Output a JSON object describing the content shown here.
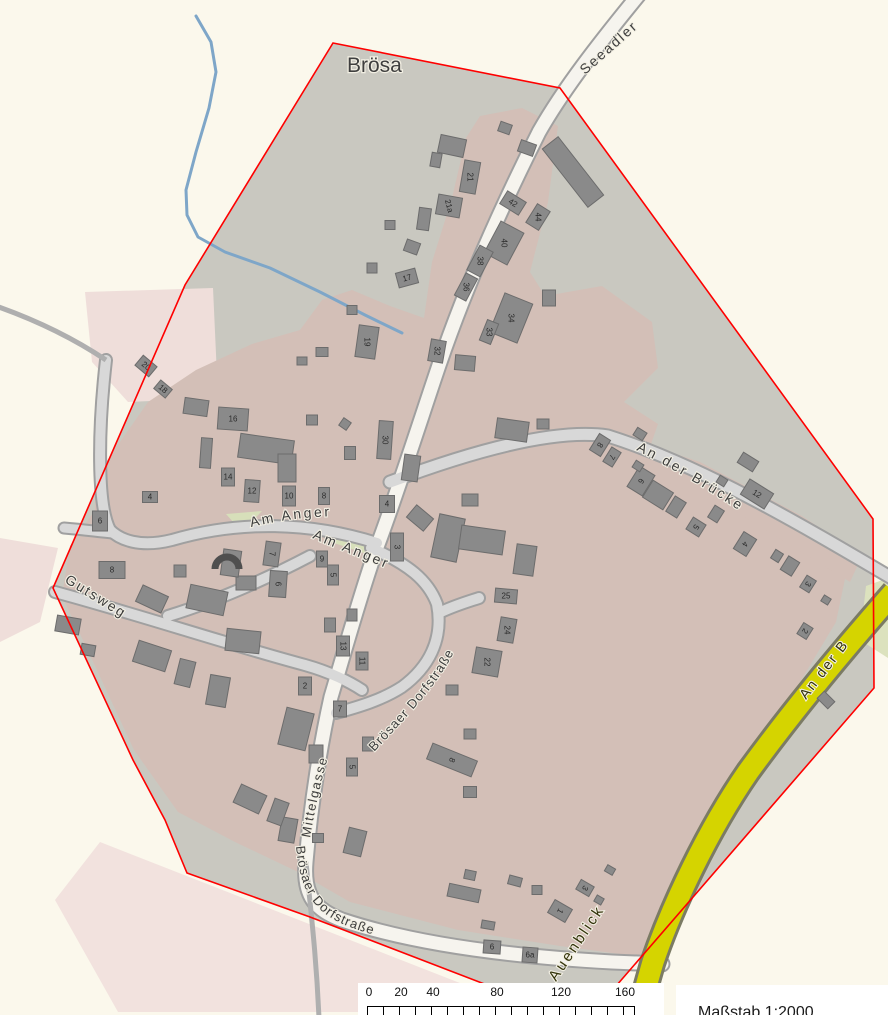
{
  "map": {
    "place_label": "Brösa",
    "scale_text": "Maßstab 1:2000",
    "colors": {
      "bg": "#FBF8EC",
      "interior": "#C9C8C0",
      "residential": "#D3BFB7",
      "residential_light": "#EFDEDA",
      "green": "#D7DFBA",
      "road_minor": "#D8D8D8",
      "road_main": "#F6F4EE",
      "road_casing": "#A0A0A0",
      "road_yellow": "#D5D400",
      "yellow_casing": "#7B7B64",
      "track": "#AFAFAF",
      "stream": "#7EA6C8",
      "boundary": "#FF0000",
      "building": "#8A8A8A",
      "building_stroke": "#6C6C6C",
      "label": "#3D3D3D",
      "halo": "#F2EFE3",
      "number": "#2B2B2B"
    },
    "boundary_pts": "333,43 560,88 873,519 874,688 597,1008 500,990 310,917 187,873 165,820 133,760 53,588 185,285",
    "areas": [
      {
        "id": "interior",
        "pts": "333,43 560,88 873,519 874,688 597,1008 500,990 310,917 187,873 165,820 133,760 53,588 185,285",
        "fill": "#C9C8C0"
      },
      {
        "id": "light-pink-nw",
        "pts": "85,292 213,288 218,398 128,402 92,362",
        "fill": "#EFDEDA"
      },
      {
        "id": "light-pink-w",
        "pts": "0,538 58,548 40,622 0,642",
        "fill": "#EFDEDA"
      },
      {
        "id": "light-pink-sw",
        "pts": "100,842 465,985 430,1012 118,1012 55,900",
        "fill": "#F2E2DE"
      },
      {
        "id": "residential-main",
        "pts": "95,478 148,402 196,370 252,344 300,330 322,300 352,290 390,306 424,318 432,262 452,198 466,138 480,116 522,108 558,126 548,202 530,272 545,296 602,286 652,322 658,368 624,402 658,424 642,470 700,490 782,534 846,574 836,622 800,682 744,766 694,856 668,936 650,958 560,946 458,930 350,902 298,872 235,842 178,812 134,750 90,655 62,596 70,546 95,510",
        "fill": "#D3BFB7"
      },
      {
        "id": "residential-bruecke",
        "pts": "598,428 700,462 802,516 862,556 850,582 740,514 640,470 592,446",
        "fill": "#D3BFB7"
      },
      {
        "id": "green-e",
        "pts": "866,586 888,578 888,658 860,640",
        "fill": "#DCE2BE"
      },
      {
        "id": "green-anger-1",
        "pts": "226,514 262,511 242,532",
        "fill": "#D7DFBA"
      },
      {
        "id": "green-anger-2",
        "pts": "330,527 374,537 364,553 328,541",
        "fill": "#D7DFBA"
      }
    ],
    "stream_pts": "196,16 211,42 216,72 209,108 196,152 186,190 187,215 198,237 225,252 270,268 320,292 365,315 402,333",
    "roads": [
      {
        "id": "broesaer-dorfstrasse-main",
        "path": "M641,-8 C600,42 564,88 539,132 C500,210 463,292 434,380 C414,440 394,502 377,547 C361,592 345,650 331,697 C321,742 311,802 306,862 C303,897 316,910 342,920 C420,946 520,957 612,962 L662,964",
        "w": 13,
        "cw": 17,
        "fill": "#F6F4EE"
      },
      {
        "id": "an-der-bruecke",
        "path": "M390,482 C470,452 555,428 608,436 C700,465 800,524 895,580",
        "w": 11,
        "cw": 15,
        "fill": "#D8D8D8"
      },
      {
        "id": "am-anger-w",
        "path": "M377,543 C310,522 240,520 172,540 C140,548 120,540 110,530",
        "w": 10,
        "cw": 14,
        "fill": "#D8D8D8"
      },
      {
        "id": "loop-nw",
        "path": "M110,530 C97,505 98,430 106,360",
        "w": 10,
        "cw": 14,
        "fill": "#D8D8D8"
      },
      {
        "id": "stub-w",
        "path": "M64,528 C88,530 100,532 114,533",
        "w": 9,
        "cw": 13,
        "fill": "#D8D8D8"
      },
      {
        "id": "gutsweg",
        "path": "M55,592 C140,615 230,645 305,665 C330,672 350,682 362,690",
        "w": 10,
        "cw": 14,
        "fill": "#D8D8D8"
      },
      {
        "id": "sw-diagonal",
        "path": "M310,556 C270,577 220,600 168,616",
        "w": 10,
        "cw": 14,
        "fill": "#D8D8D8"
      },
      {
        "id": "am-anger-s",
        "path": "M371,548 C408,564 428,580 437,604 C444,640 428,668 402,687 C382,700 358,707 336,713",
        "w": 10,
        "cw": 14,
        "fill": "#D8D8D8"
      },
      {
        "id": "culdesac",
        "path": "M441,612 C456,605 470,601 479,598",
        "w": 10,
        "cw": 14,
        "fill": "#D8D8D8"
      }
    ],
    "yellow_road": {
      "id": "auenblick-road",
      "path": "M894,592 C850,642 796,706 748,772 C708,830 672,906 653,962 C646,986 642,1000 640,1018",
      "w": 21,
      "cw": 27,
      "fill": "#D5D400",
      "casing": "#7B7B64"
    },
    "tracks": [
      {
        "id": "track-w",
        "path": "M-4,306 C30,318 70,336 106,360",
        "w": 5
      },
      {
        "id": "track-s",
        "path": "M306,862 C310,905 316,950 319,1018",
        "w": 5
      }
    ],
    "arc_feature": {
      "cx": 227,
      "cy": 565,
      "r": 12
    },
    "buildings": [
      [
        452,
        146,
        26,
        18,
        12
      ],
      [
        470,
        177,
        16,
        32,
        10,
        "21",
        90
      ],
      [
        449,
        206,
        24,
        20,
        10,
        "21a",
        75
      ],
      [
        424,
        219,
        12,
        22,
        8
      ],
      [
        436,
        160,
        10,
        14,
        10
      ],
      [
        412,
        247,
        14,
        12,
        20
      ],
      [
        390,
        225,
        10,
        9,
        0
      ],
      [
        372,
        268,
        10,
        10,
        0
      ],
      [
        407,
        278,
        20,
        15,
        -15,
        "17",
        -15
      ],
      [
        367,
        342,
        20,
        32,
        8,
        "19",
        90
      ],
      [
        352,
        310,
        10,
        9,
        0
      ],
      [
        322,
        352,
        12,
        9,
        0
      ],
      [
        302,
        361,
        10,
        8,
        0
      ],
      [
        573,
        172,
        20,
        74,
        -38
      ],
      [
        513,
        203,
        22,
        15,
        32,
        "42",
        32
      ],
      [
        538,
        217,
        15,
        22,
        32,
        "44",
        90
      ],
      [
        504,
        243,
        26,
        36,
        28,
        "40",
        90
      ],
      [
        480,
        261,
        15,
        28,
        28,
        "38",
        90
      ],
      [
        466,
        287,
        13,
        25,
        28,
        "36",
        90
      ],
      [
        511,
        318,
        30,
        42,
        22,
        "34",
        90
      ],
      [
        489,
        332,
        12,
        22,
        22,
        "33",
        90
      ],
      [
        437,
        351,
        15,
        22,
        10,
        "32",
        90
      ],
      [
        465,
        363,
        20,
        15,
        5
      ],
      [
        549,
        298,
        13,
        16,
        0
      ],
      [
        527,
        148,
        16,
        12,
        20
      ],
      [
        505,
        128,
        12,
        10,
        20
      ],
      [
        512,
        430,
        32,
        20,
        8
      ],
      [
        543,
        424,
        12,
        10,
        0
      ],
      [
        146,
        366,
        18,
        13,
        40,
        "20",
        40
      ],
      [
        163,
        389,
        15,
        11,
        40,
        "18",
        40
      ],
      [
        196,
        407,
        24,
        16,
        8
      ],
      [
        233,
        419,
        30,
        22,
        4,
        "16",
        0
      ],
      [
        206,
        453,
        11,
        30,
        4
      ],
      [
        228,
        477,
        13,
        18,
        0,
        "14",
        0
      ],
      [
        252,
        491,
        15,
        22,
        4,
        "12",
        0
      ],
      [
        289,
        496,
        13,
        20,
        0,
        "10",
        0
      ],
      [
        324,
        496,
        11,
        17,
        0,
        "8",
        0
      ],
      [
        266,
        449,
        54,
        24,
        8
      ],
      [
        287,
        468,
        18,
        28,
        0
      ],
      [
        312,
        420,
        11,
        10,
        0
      ],
      [
        345,
        424,
        9,
        9,
        35
      ],
      [
        350,
        453,
        11,
        13,
        0
      ],
      [
        150,
        497,
        15,
        11,
        0,
        "4",
        0
      ],
      [
        385,
        440,
        14,
        38,
        4,
        "30",
        90
      ],
      [
        411,
        468,
        16,
        26,
        8
      ],
      [
        387,
        504,
        15,
        17,
        0,
        "4",
        0
      ],
      [
        397,
        547,
        13,
        28,
        0,
        "3",
        90
      ],
      [
        420,
        518,
        22,
        16,
        40
      ],
      [
        448,
        538,
        26,
        44,
        12
      ],
      [
        482,
        540,
        44,
        24,
        8
      ],
      [
        525,
        560,
        20,
        30,
        8
      ],
      [
        470,
        500,
        16,
        12,
        0
      ],
      [
        272,
        554,
        15,
        24,
        8,
        "7",
        90
      ],
      [
        322,
        559,
        11,
        16,
        0,
        "9",
        0
      ],
      [
        333,
        575,
        11,
        20,
        0,
        "5",
        90
      ],
      [
        278,
        584,
        17,
        26,
        4,
        "6",
        90
      ],
      [
        246,
        583,
        20,
        14,
        0
      ],
      [
        112,
        570,
        26,
        17,
        0,
        "8",
        0
      ],
      [
        100,
        521,
        15,
        20,
        0,
        "6",
        0
      ],
      [
        152,
        599,
        28,
        18,
        25
      ],
      [
        207,
        600,
        38,
        24,
        12
      ],
      [
        231,
        563,
        18,
        26,
        8
      ],
      [
        180,
        571,
        12,
        12,
        0
      ],
      [
        152,
        656,
        34,
        22,
        18
      ],
      [
        185,
        673,
        16,
        26,
        14
      ],
      [
        218,
        691,
        20,
        30,
        10
      ],
      [
        243,
        641,
        34,
        22,
        6
      ],
      [
        68,
        625,
        24,
        16,
        10
      ],
      [
        88,
        650,
        14,
        11,
        10
      ],
      [
        506,
        596,
        22,
        14,
        5,
        "25",
        0
      ],
      [
        507,
        630,
        16,
        24,
        10,
        "24",
        90
      ],
      [
        487,
        662,
        26,
        26,
        10,
        "22",
        90
      ],
      [
        452,
        690,
        12,
        10,
        0
      ],
      [
        343,
        646,
        13,
        20,
        0,
        "13",
        90
      ],
      [
        362,
        661,
        12,
        18,
        0,
        "11",
        90
      ],
      [
        305,
        686,
        13,
        18,
        0,
        "2",
        0
      ],
      [
        330,
        625,
        11,
        14,
        0
      ],
      [
        352,
        615,
        10,
        12,
        0
      ],
      [
        340,
        709,
        13,
        16,
        0,
        "7",
        0
      ],
      [
        352,
        767,
        11,
        18,
        0,
        "5",
        90
      ],
      [
        296,
        729,
        28,
        38,
        14
      ],
      [
        316,
        754,
        14,
        18,
        0
      ],
      [
        288,
        830,
        16,
        24,
        10
      ],
      [
        355,
        842,
        18,
        26,
        14
      ],
      [
        368,
        744,
        11,
        14,
        0
      ],
      [
        250,
        799,
        28,
        20,
        25
      ],
      [
        278,
        812,
        15,
        24,
        20
      ],
      [
        318,
        838,
        11,
        9,
        0
      ],
      [
        452,
        760,
        48,
        17,
        22,
        "8",
        112
      ],
      [
        470,
        792,
        13,
        11,
        0
      ],
      [
        470,
        734,
        12,
        10,
        0
      ],
      [
        464,
        893,
        32,
        13,
        12
      ],
      [
        470,
        875,
        11,
        9,
        12
      ],
      [
        515,
        881,
        13,
        9,
        15
      ],
      [
        537,
        890,
        10,
        9,
        0
      ],
      [
        560,
        911,
        20,
        15,
        30,
        "1",
        120
      ],
      [
        585,
        888,
        15,
        11,
        30,
        "3",
        120
      ],
      [
        599,
        900,
        8,
        7,
        30
      ],
      [
        492,
        947,
        17,
        13,
        4,
        "6",
        0
      ],
      [
        530,
        955,
        15,
        15,
        4,
        "6a",
        0
      ],
      [
        488,
        925,
        13,
        8,
        10
      ],
      [
        600,
        445,
        13,
        19,
        32,
        "8",
        122
      ],
      [
        612,
        457,
        11,
        17,
        32,
        "7",
        122
      ],
      [
        641,
        481,
        18,
        24,
        32,
        "6",
        122
      ],
      [
        658,
        495,
        24,
        20,
        32
      ],
      [
        676,
        507,
        13,
        18,
        32
      ],
      [
        696,
        527,
        15,
        14,
        32,
        "5",
        122
      ],
      [
        716,
        514,
        11,
        14,
        32
      ],
      [
        745,
        544,
        15,
        20,
        32,
        "4",
        122
      ],
      [
        757,
        494,
        28,
        18,
        32,
        "12",
        32
      ],
      [
        790,
        566,
        13,
        16,
        32
      ],
      [
        808,
        584,
        11,
        14,
        32,
        "3",
        122
      ],
      [
        805,
        631,
        11,
        13,
        32,
        "2",
        122
      ],
      [
        640,
        434,
        11,
        9,
        32
      ],
      [
        722,
        481,
        9,
        8,
        32
      ],
      [
        777,
        556,
        9,
        10,
        32
      ],
      [
        826,
        600,
        8,
        7,
        32
      ],
      [
        826,
        700,
        15,
        10,
        45
      ],
      [
        638,
        466,
        9,
        8,
        32
      ],
      [
        748,
        462,
        18,
        12,
        32
      ],
      [
        610,
        870,
        9,
        7,
        30
      ]
    ],
    "labels": [
      {
        "id": "broesa",
        "text": "Brösa",
        "type": "point",
        "x": 347,
        "y": 72,
        "size": 21,
        "color": "#3F3F3F"
      },
      {
        "id": "seeadler",
        "text": "Seeadler",
        "path": "M585,75 L728,-52",
        "size": 14,
        "spacing": 2
      },
      {
        "id": "am-anger-1",
        "text": "Am Anger",
        "path": "M251,527 Q330,508 412,522",
        "size": 14,
        "spacing": 2.5
      },
      {
        "id": "am-anger-2",
        "text": "Am Anger",
        "path": "M312,538 C355,557 400,570 430,592 C440,600 446,610 450,622",
        "size": 14,
        "spacing": 2.5
      },
      {
        "id": "gutsweg",
        "text": "Gutsweg",
        "path": "M64,582 L148,634",
        "size": 14,
        "spacing": 2
      },
      {
        "id": "mittelgasse",
        "text": "Mittelgasse",
        "path": "M310,838 Q321,772 344,706",
        "size": 13,
        "spacing": 1.5
      },
      {
        "id": "broesaer-dorfstrasse-1",
        "text": "Brösaer Dorfstraße",
        "path": "M374,752 C408,716 438,684 454,652 C466,630 472,616 484,602",
        "size": 13,
        "spacing": 1
      },
      {
        "id": "broesaer-dorfstrasse-2",
        "text": "Brösaer Dorfstraße",
        "path": "M296,846 C300,894 316,914 350,927 C385,940 420,946 465,950",
        "size": 13,
        "spacing": 1
      },
      {
        "id": "an-der-bruecke",
        "text": "An der Brücke",
        "path": "M636,450 Q715,490 795,550",
        "size": 14,
        "spacing": 2.5
      },
      {
        "id": "an-der-b",
        "text": "An der B",
        "path": "M806,700 L888,594",
        "size": 14,
        "spacing": 2,
        "color": "#33330A"
      },
      {
        "id": "auenblick",
        "text": "Auenblick",
        "path": "M556,982 L646,848",
        "size": 15,
        "spacing": 2.5,
        "color": "#33330A"
      }
    ],
    "scalebar": {
      "ticks": [
        {
          "label": "0",
          "x": 11
        },
        {
          "label": "20",
          "x": 43
        },
        {
          "label": "40",
          "x": 75
        },
        {
          "label": "80",
          "x": 139
        },
        {
          "label": "120",
          "x": 203
        },
        {
          "label": "160",
          "x": 267
        }
      ]
    }
  }
}
